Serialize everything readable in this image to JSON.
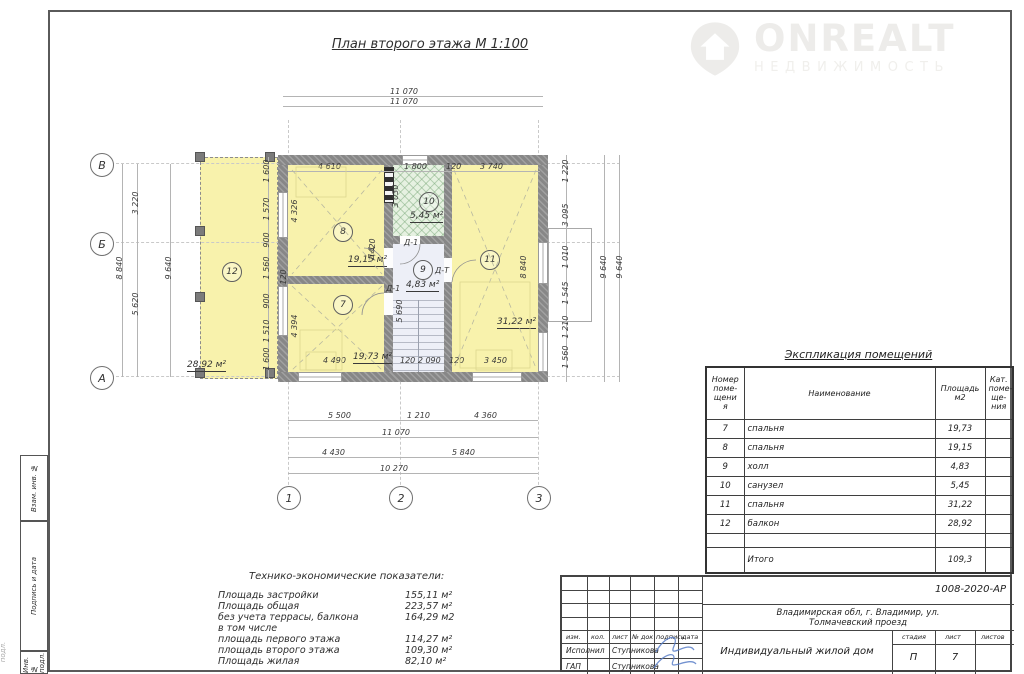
{
  "watermark": {
    "brand": "ONREALT",
    "subtitle": "НЕДВИЖИМОСТЬ"
  },
  "plan": {
    "title": "План второго этажа М 1:100",
    "axis_rows": [
      "В",
      "Б",
      "А"
    ],
    "axis_cols": [
      "1",
      "2",
      "3"
    ],
    "rooms": {
      "r7": {
        "num": "7",
        "area": "19,73 м²"
      },
      "r8": {
        "num": "8",
        "area": "19,15 м²"
      },
      "r9": {
        "num": "9",
        "area": "4,83 м²"
      },
      "r10": {
        "num": "10",
        "area": "5,45 м²"
      },
      "r11": {
        "num": "11",
        "area": "31,22 м²"
      },
      "r12": {
        "num": "12",
        "area": "28,92 м²"
      }
    },
    "doors": [
      "Д-1",
      "Д-1",
      "Д-1",
      "Д-Т"
    ],
    "dims": {
      "top_overall_1": "11 070",
      "top_overall_2": "11 070",
      "top_inner": [
        "4 610",
        "1 800",
        "120",
        "3 740"
      ],
      "left_inner": [
        "1 600",
        "1 570",
        "900",
        "1 560",
        "120",
        "900",
        "1 510",
        "1 600"
      ],
      "left_outer": {
        "span_top": "3 220",
        "span_bottom": "5 620",
        "total": "8 840",
        "overall": "9 640"
      },
      "room8_width": "4 326",
      "room7_width": "4 394",
      "right_inner": [
        "1 220",
        "3 095",
        "1 010",
        "1 545",
        "1 210",
        "1 560"
      ],
      "right_total": "9 640",
      "right_overall": "9 640",
      "room11_height": "8 840",
      "bath_height": "3 030",
      "stair_height": "5 690",
      "door_width": "420",
      "bottom_inner": [
        "4 490",
        "120 2 090",
        "120",
        "3 450"
      ],
      "bottom_chain1": [
        "5 500",
        "1 210",
        "4 360"
      ],
      "bottom_total1": "11 070",
      "bottom_chain2": [
        "4 430",
        "5 840"
      ],
      "bottom_total2": "10 270"
    }
  },
  "explication": {
    "title": "Экспликация помещений",
    "headers": {
      "num": "Номер\nпоме-\nщени\nя",
      "name": "Наименование",
      "area": "Площадь\nм2",
      "cat": "Кат.\nпоме-\nще-\nния"
    },
    "rows": [
      {
        "num": "7",
        "name": "спальня",
        "area": "19,73"
      },
      {
        "num": "8",
        "name": "спальня",
        "area": "19,15"
      },
      {
        "num": "9",
        "name": "холл",
        "area": "4,83"
      },
      {
        "num": "10",
        "name": "санузел",
        "area": "5,45"
      },
      {
        "num": "11",
        "name": "спальня",
        "area": "31,22"
      },
      {
        "num": "12",
        "name": "балкон",
        "area": "28,92"
      }
    ],
    "total_label": "Итого",
    "total_area": "109,3"
  },
  "tech": {
    "title": "Технико-экономические показатели:",
    "rows": [
      {
        "label": "Площадь застройки",
        "value": "155,11 м²"
      },
      {
        "label": "Площадь общая",
        "value": "223,57 м²"
      },
      {
        "label": "без учета террасы, балкона",
        "value": "164,29 м2"
      },
      {
        "label": "в том числе",
        "value": ""
      },
      {
        "label": "площадь первого этажа",
        "value": "114,27 м²"
      },
      {
        "label": "площадь второго этажа",
        "value": "109,30 м²"
      },
      {
        "label": "Площадь жилая",
        "value": "82,10 м²"
      }
    ]
  },
  "stamp": {
    "doc_number": "1008-2020-АР",
    "address": "Владимирская обл, г. Владимир, ул.\nТолмачевский проезд",
    "project": "Индивидуальный жилой дом",
    "header_cols": [
      "изм.",
      "кол.",
      "лист",
      "№ док",
      "подпись",
      "дата"
    ],
    "sign_rows": [
      {
        "role": "Исполнил",
        "name": "Ступникова"
      },
      {
        "role": "ГАП",
        "name": "Ступникова"
      }
    ],
    "stage_label": "стадия",
    "sheet_label": "лист",
    "sheets_label": "листов",
    "stage": "П",
    "sheet": "7",
    "sheets": ""
  },
  "side_labels": [
    "Взам. инв. №",
    "Подпись и дата",
    "Инв. № подл."
  ],
  "edge_label": "подл.",
  "colors": {
    "wall": "#878787",
    "room": "#f8f2ac",
    "bath": "#e6f1e1",
    "hall": "#edeff7",
    "watermark": "#edecea",
    "signature": "#5b7fc8",
    "dim_text": "#3a3a3a"
  }
}
